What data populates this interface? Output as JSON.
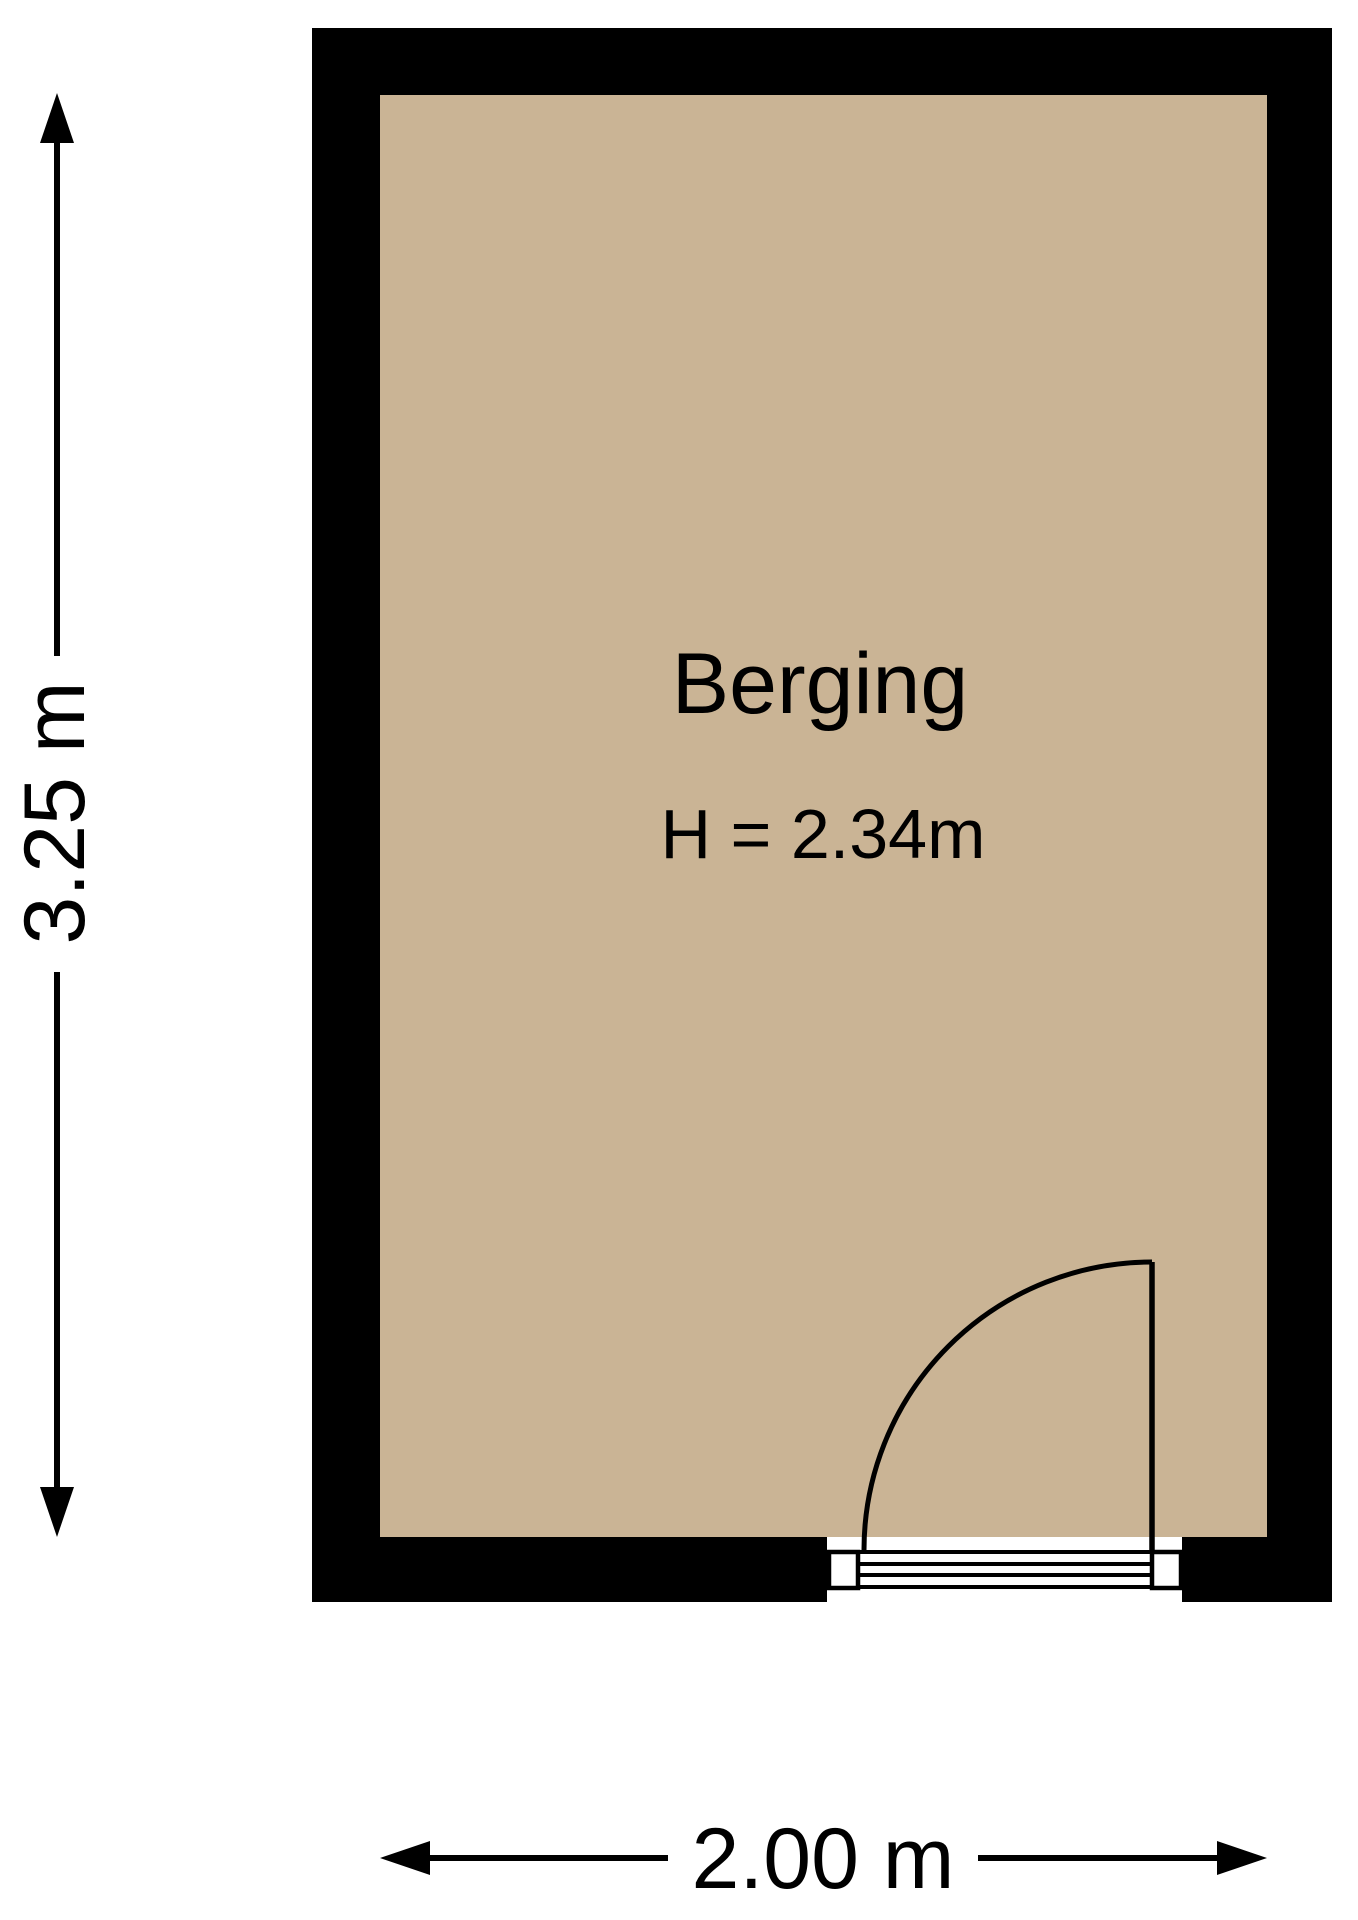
{
  "floorplan": {
    "room": {
      "name": "Berging",
      "ceiling_height_label": "H = 2.34m"
    },
    "dimensions": {
      "vertical_label": "3.25 m",
      "horizontal_label": "2.00 m"
    },
    "colors": {
      "wall": "#000000",
      "floor": "#CAB495",
      "line": "#000000",
      "background": "#ffffff"
    }
  }
}
